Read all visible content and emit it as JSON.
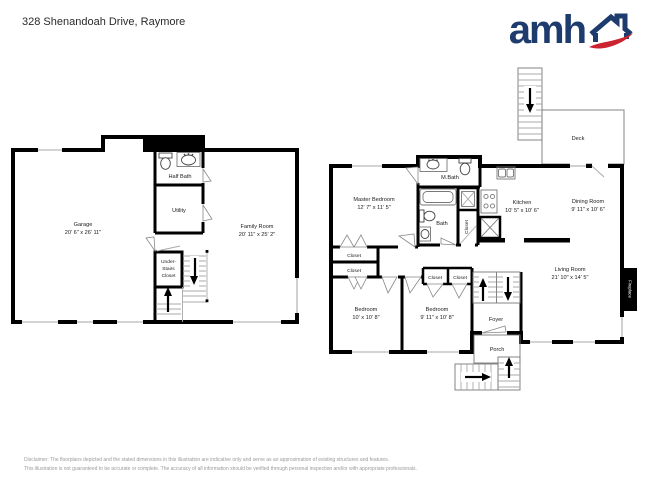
{
  "header": {
    "address": "328 Shenandoah Drive, Raymore",
    "logo_text": "amh"
  },
  "colors": {
    "logo_blue": "#1d3c6d",
    "logo_red": "#cc2330",
    "wall": "#000000",
    "stair": "#a8a8a8",
    "muted": "#9a9a9a"
  },
  "lower_plan": {
    "garage": {
      "name": "Garage",
      "dims": "20' 6\" x 26' 11\""
    },
    "half_bath": {
      "name": "Half Bath"
    },
    "utility": {
      "name": "Utility"
    },
    "family_room": {
      "name": "Family Room",
      "dims": "20' 11\" x 25' 2\""
    },
    "under_stairs_closet": {
      "line1": "Under-",
      "line2": "Stairs",
      "line3": "Closet"
    }
  },
  "main_plan": {
    "deck": {
      "name": "Deck"
    },
    "master_bedroom": {
      "name": "Master Bedroom",
      "dims": "12' 7\" x 11' 5\""
    },
    "m_bath": {
      "name": "M.Bath"
    },
    "bath": {
      "name": "Bath"
    },
    "bath_closet": {
      "name": "Closet"
    },
    "kitchen": {
      "name": "Kitchen",
      "dims": "10' 5\" x 10' 6\""
    },
    "dining_room": {
      "name": "Dining Room",
      "dims": "9' 11\" x 10' 6\""
    },
    "living_room": {
      "name": "Living Room",
      "dims": "21' 10\" x 14' 5\""
    },
    "fireplace": {
      "name": "Fireplace"
    },
    "hall_closet_1": {
      "name": "Closet"
    },
    "hall_closet_2": {
      "name": "Closet"
    },
    "bedroom_1": {
      "name": "Bedroom",
      "dims": "10' x 10' 8\""
    },
    "bedroom_2": {
      "name": "Bedroom",
      "dims": "9' 11\" x 10' 8\""
    },
    "bedroom_closet_1": {
      "name": "Closet"
    },
    "bedroom_closet_2": {
      "name": "Closet"
    },
    "foyer": {
      "name": "Foyer"
    },
    "porch": {
      "name": "Porch"
    }
  },
  "footer": {
    "disclaimer_line1": "Disclaimer: The floorplans depicted and the stated dimensions in this illustration are indicative only and serve as an approximation of existing structures and features.",
    "disclaimer_line2": "This illustration is not guaranteed to be accurate or complete. The accuracy of all information should be verified through personal inspection and/or with appropriate professionals."
  }
}
